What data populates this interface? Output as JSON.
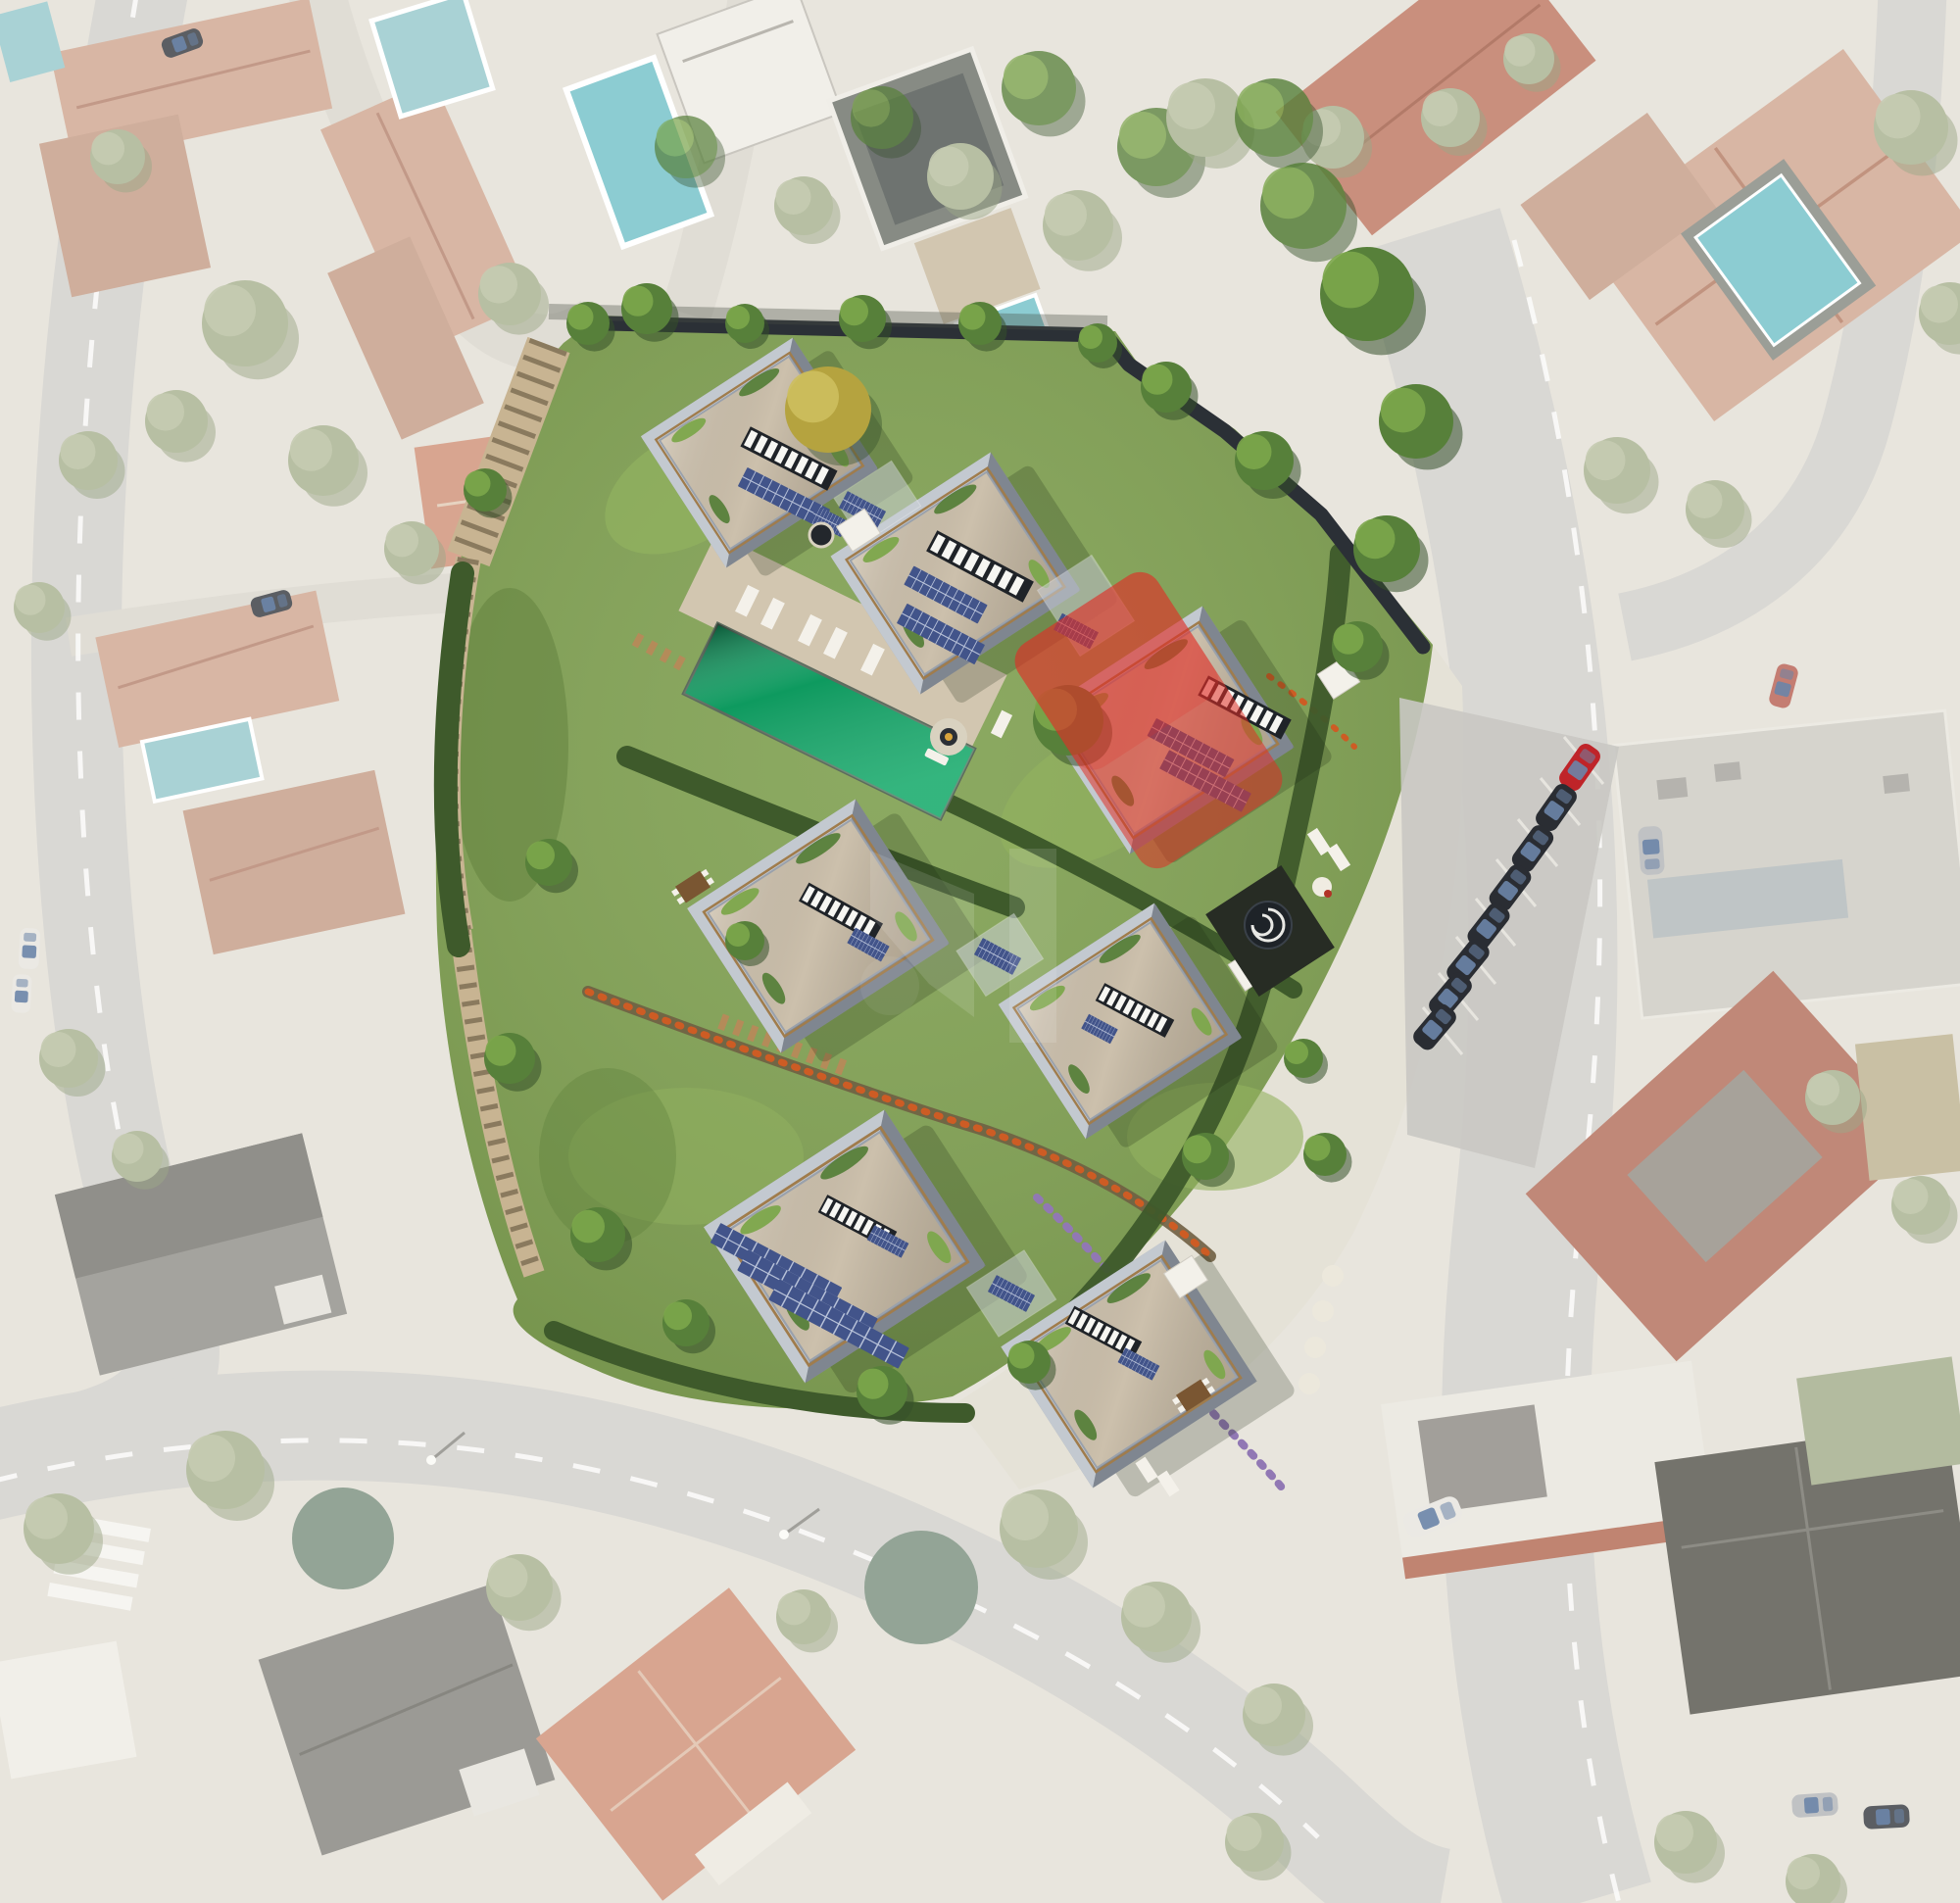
{
  "scene": {
    "type": "real-estate-development-aerial-masterplan",
    "background": "desaturated-satellite-photo-of-residential-neighborhood",
    "site": {
      "villa_count": 7,
      "villas": [
        {
          "id": "villa-1",
          "roof": "gravel-green-edge",
          "skylight": true,
          "solar_arrays": 2,
          "highlighted": false
        },
        {
          "id": "villa-2",
          "roof": "gravel-green-edge",
          "skylight": true,
          "solar_arrays": 2,
          "highlighted": false
        },
        {
          "id": "villa-3",
          "roof": "gravel-green-edge",
          "skylight": true,
          "solar_arrays": 2,
          "highlighted": true,
          "highlight_color": "#e02f26",
          "highlight_opacity": 0.55
        },
        {
          "id": "villa-4",
          "roof": "gravel-green-edge",
          "skylight": true,
          "solar_arrays": 1,
          "highlighted": false
        },
        {
          "id": "villa-5",
          "roof": "gravel-green-edge",
          "skylight": true,
          "solar_arrays": 1,
          "highlighted": false
        },
        {
          "id": "villa-6",
          "roof": "gravel-green-edge",
          "skylight": true,
          "solar_arrays": 4,
          "highlighted": false
        },
        {
          "id": "villa-7",
          "roof": "gravel-green-edge",
          "skylight": true,
          "solar_arrays": 1,
          "highlighted": false
        }
      ],
      "pool": {
        "kind": "lap-pool",
        "color": "#0e9a5f",
        "loungers": 5,
        "fire_pit": true
      },
      "features": [
        "timber-steps",
        "garden-paths",
        "glass-links",
        "spiral-staircase",
        "white-canopies",
        "flower-beds",
        "hedgerows",
        "green-roofs",
        "solar-panels"
      ]
    },
    "parking": {
      "car_count": 8,
      "car_colors": [
        "#bf2429",
        "#2a2d33",
        "#2a2d33",
        "#2a2d33",
        "#2a2d33",
        "#2a2d33",
        "#2a2d33",
        "#2a2d33"
      ]
    },
    "watermark": {
      "color": "#ffffff",
      "opacity": 0.12
    }
  },
  "colors": {
    "land": "#e8e5dd",
    "road": "#d9d8d4",
    "road_dash": "#fbfbf9",
    "sidewalk": "#e5e2d7",
    "driveway": "#e0ddd5",
    "lot_gray": "#c9c8c3",
    "terracotta": "#d8b6a4",
    "terracotta2": "#cfae9c",
    "roof_ridge": "#c29988",
    "salmon": "#d8a590",
    "red_roof_pale": "#c98f7d",
    "dark_roof_pale": "#9b9a95",
    "white_bld": "#f1efe9",
    "gray_bld": "#d6d4cd",
    "pool_pale": "#a9d2d5",
    "pool_bright": "#8cccd2",
    "tree_pale1": "#b7bfa3",
    "tree_pale2": "#c5cbb1",
    "tree_pale_dark": "#9ca887",
    "tree_sage": "#93a496",
    "lawn": "#7fa050",
    "lawn_light": "#92b25f",
    "lawn_dark": "#5d7d3a",
    "hedge": "#3e5a2b",
    "tree_green": "#57803a",
    "tree_green_light": "#7ca64b",
    "tree_green_dark": "#35502a",
    "tree_yellow": "#b5a33f",
    "bed_soil": "#6f5f43",
    "flower_orange": "#cd5c24",
    "flower_purple": "#9178b4",
    "path_pale": "#ddd7c8",
    "deck_wood": "#b48b59",
    "stair_wood": "#c8b492",
    "stair_dark": "#8a7a5e",
    "deck_stone": "#d2c6b0",
    "fence": "#2b3036",
    "wall": "#9aa1ab",
    "wall_light": "#c8cdd4",
    "wall_shadow": "#747b85",
    "trim": "#a07c4c",
    "roof_gravel": "#ccc0ac",
    "skylight": "#1f2328",
    "slat": "#f6f6f2",
    "solar": "#42548a",
    "solar_grid": "#dfe5f2",
    "glass": "#ccd1d7",
    "pool_green": "#0e9a5f",
    "white": "#f3f1ea",
    "red_highlight": "#e02f26",
    "red_car": "#bf2429",
    "dark_car": "#2a2d33",
    "gray_car": "#c0c2c4",
    "white_car": "#ebe9e4",
    "car_window": "#6c85a8",
    "car_red_pale": "#c47d72",
    "car_dark_pale": "#5b5e63",
    "spiral_dark": "#1e2328",
    "watermark": "#ffffff"
  }
}
